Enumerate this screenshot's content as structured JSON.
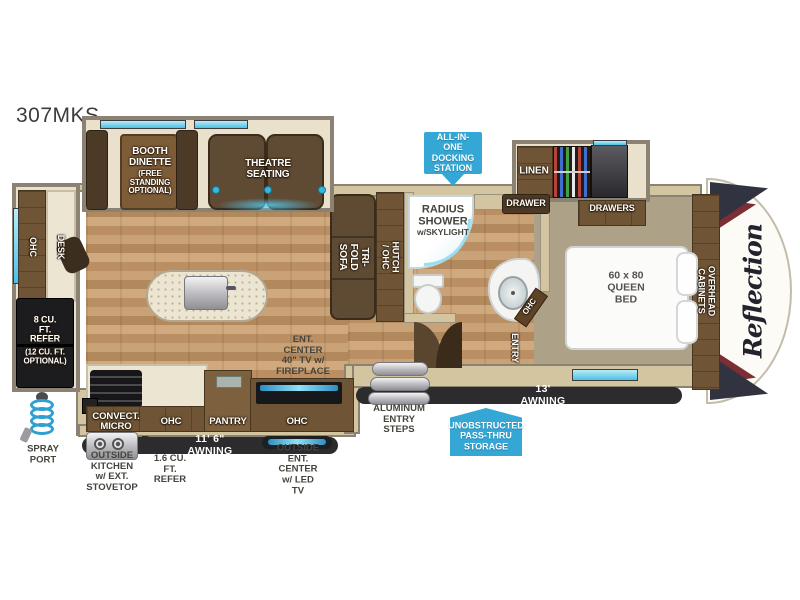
{
  "title": "307MKS",
  "front_cap_logo": "Reflection",
  "colors": {
    "callout_blue": "#35a7d5",
    "awning_dark": "#2c2c2e",
    "wall_gray": "#8b8274",
    "wall_tan": "#d3c59f",
    "wood_floor": "#c9a277",
    "carpet": "#ada287",
    "cabinet_brown": "#6f5536",
    "window_cyan": "#4cc0e4"
  },
  "callouts": {
    "docking": "ALL-IN-ONE\nDOCKING\nSTATION",
    "pass_thru": "UNOBSTRUCTED\nPASS-THRU\nSTORAGE"
  },
  "labels": {
    "booth": "BOOTH\nDINETTE",
    "booth_opt": "(FREE STANDING\nOPTIONAL)",
    "theatre": "THEATRE SEATING",
    "ohc_rear": "OHC",
    "desk": "DESK",
    "refer": "8 CU. FT.\nREFER",
    "refer_opt": "(12 CU. FT.\nOPTIONAL)",
    "trifold": "TRI-FOLD SOFA",
    "hutch": "HUTCH / OHC",
    "shower": "RADIUS\nSHOWER",
    "shower_sub": "w/SKYLIGHT",
    "linen": "LINEN",
    "drawer": "DRAWER",
    "drawers": "DRAWERS",
    "bed": "60 x 80\nQUEEN BED",
    "overhead": "OVERHEAD CABINETS",
    "bath_ohc": "OHC",
    "entry": "ENTRY",
    "ent_center": "ENT. CENTER\n40\" TV w/ FIREPLACE",
    "convect": "CONVECT. MICRO",
    "ohc_kitchen": "OHC",
    "pantry": "PANTRY",
    "ohc_ent": "OHC",
    "steps": "ALUMINUM\nENTRY STEPS",
    "awning_13": "13' AWNING",
    "awning_11_6": "11' 6\" AWNING",
    "spray": "SPRAY\nPORT",
    "outside_kitchen": "OUTSIDE KITCHEN\nw/ EXT. STOVETOP",
    "refer_small": "1.6 CU. FT.\nREFER",
    "outside_ent": "OUTSIDE ENT. CENTER\nw/ LED TV"
  }
}
